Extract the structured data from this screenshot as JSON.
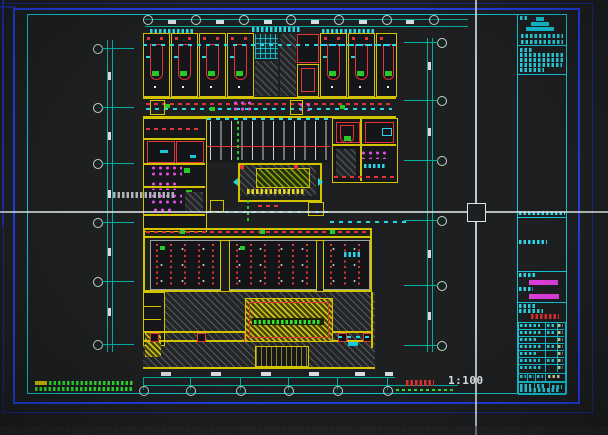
{
  "viewport": {
    "type": "cad-model-space",
    "scale_label": "1:100",
    "crosshair_position": {
      "x": 476,
      "y": 212
    }
  },
  "colors": {
    "background": "#1d1f21",
    "paper_border_blue": "#2240e8",
    "frame_cyan": "#14c8da",
    "wall_yellow": "#d4c400",
    "detail_red": "#e43434",
    "dimension_teal": "#00b0a4",
    "highlight_magenta": "#e040e0",
    "landscape_green": "#28c828",
    "crosshair_white": "#e8ecee"
  },
  "title_block": {
    "position": "right-column",
    "magenta_highlight_rows": 2,
    "red_stamp_row": 1,
    "signature_table_rows": 7
  },
  "dimensions": {
    "top_grid_bubbles": 7,
    "left_grid_bubbles": 6,
    "right_grid_bubbles": 6,
    "bottom_grid_bubbles": 6
  }
}
